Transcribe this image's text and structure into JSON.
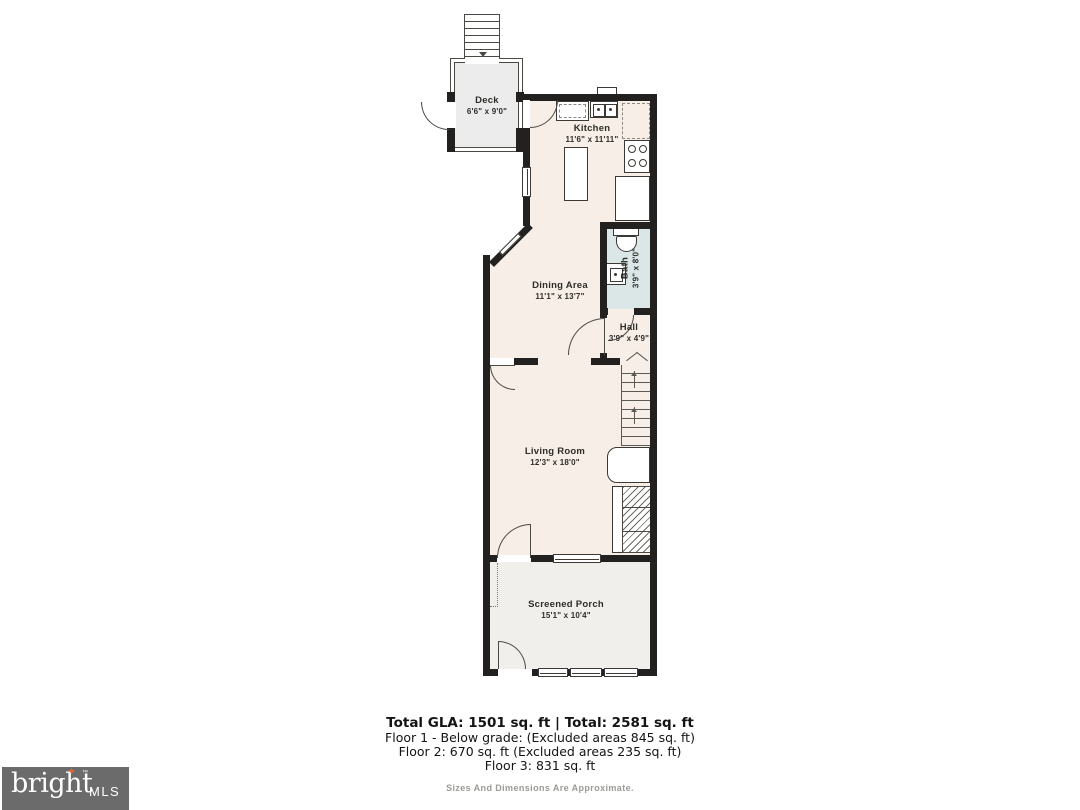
{
  "rooms": {
    "deck": {
      "name": "Deck",
      "dims": "6'6\" x 9'0\""
    },
    "kitchen": {
      "name": "Kitchen",
      "dims": "11'6\" x 11'11\""
    },
    "bath": {
      "name": "Bath",
      "dims": "3'9\" x 8'0\""
    },
    "dining": {
      "name": "Dining Area",
      "dims": "11'1\" x 13'7\""
    },
    "hall": {
      "name": "Hall",
      "dims": "3'9\" x 4'9\""
    },
    "living": {
      "name": "Living Room",
      "dims": "12'3\" x 18'0\""
    },
    "porch": {
      "name": "Screened Porch",
      "dims": "15'1\" x 10'4\""
    }
  },
  "summary": {
    "total_line": "Total GLA: 1501 sq. ft | Total: 2581 sq. ft",
    "floor1": "Floor 1 - Below grade: (Excluded areas 845 sq. ft)",
    "floor2": "Floor 2: 670 sq. ft (Excluded areas 235 sq. ft)",
    "floor3": "Floor 3: 831 sq. ft",
    "disclaimer": "Sizes And Dimensions Are Approximate."
  },
  "logo": {
    "brand": "bright",
    "mls": "MLS",
    "tm": "™",
    "spark": "✦"
  },
  "colors": {
    "wall": "#22211f",
    "floor": "#f6eee7",
    "deck": "#ececec",
    "bath_fill": "#dbe7e6",
    "porch_fill": "#f0efeb",
    "logo_bg": "#6b6b6b",
    "logo_accent": "#e0662c"
  }
}
